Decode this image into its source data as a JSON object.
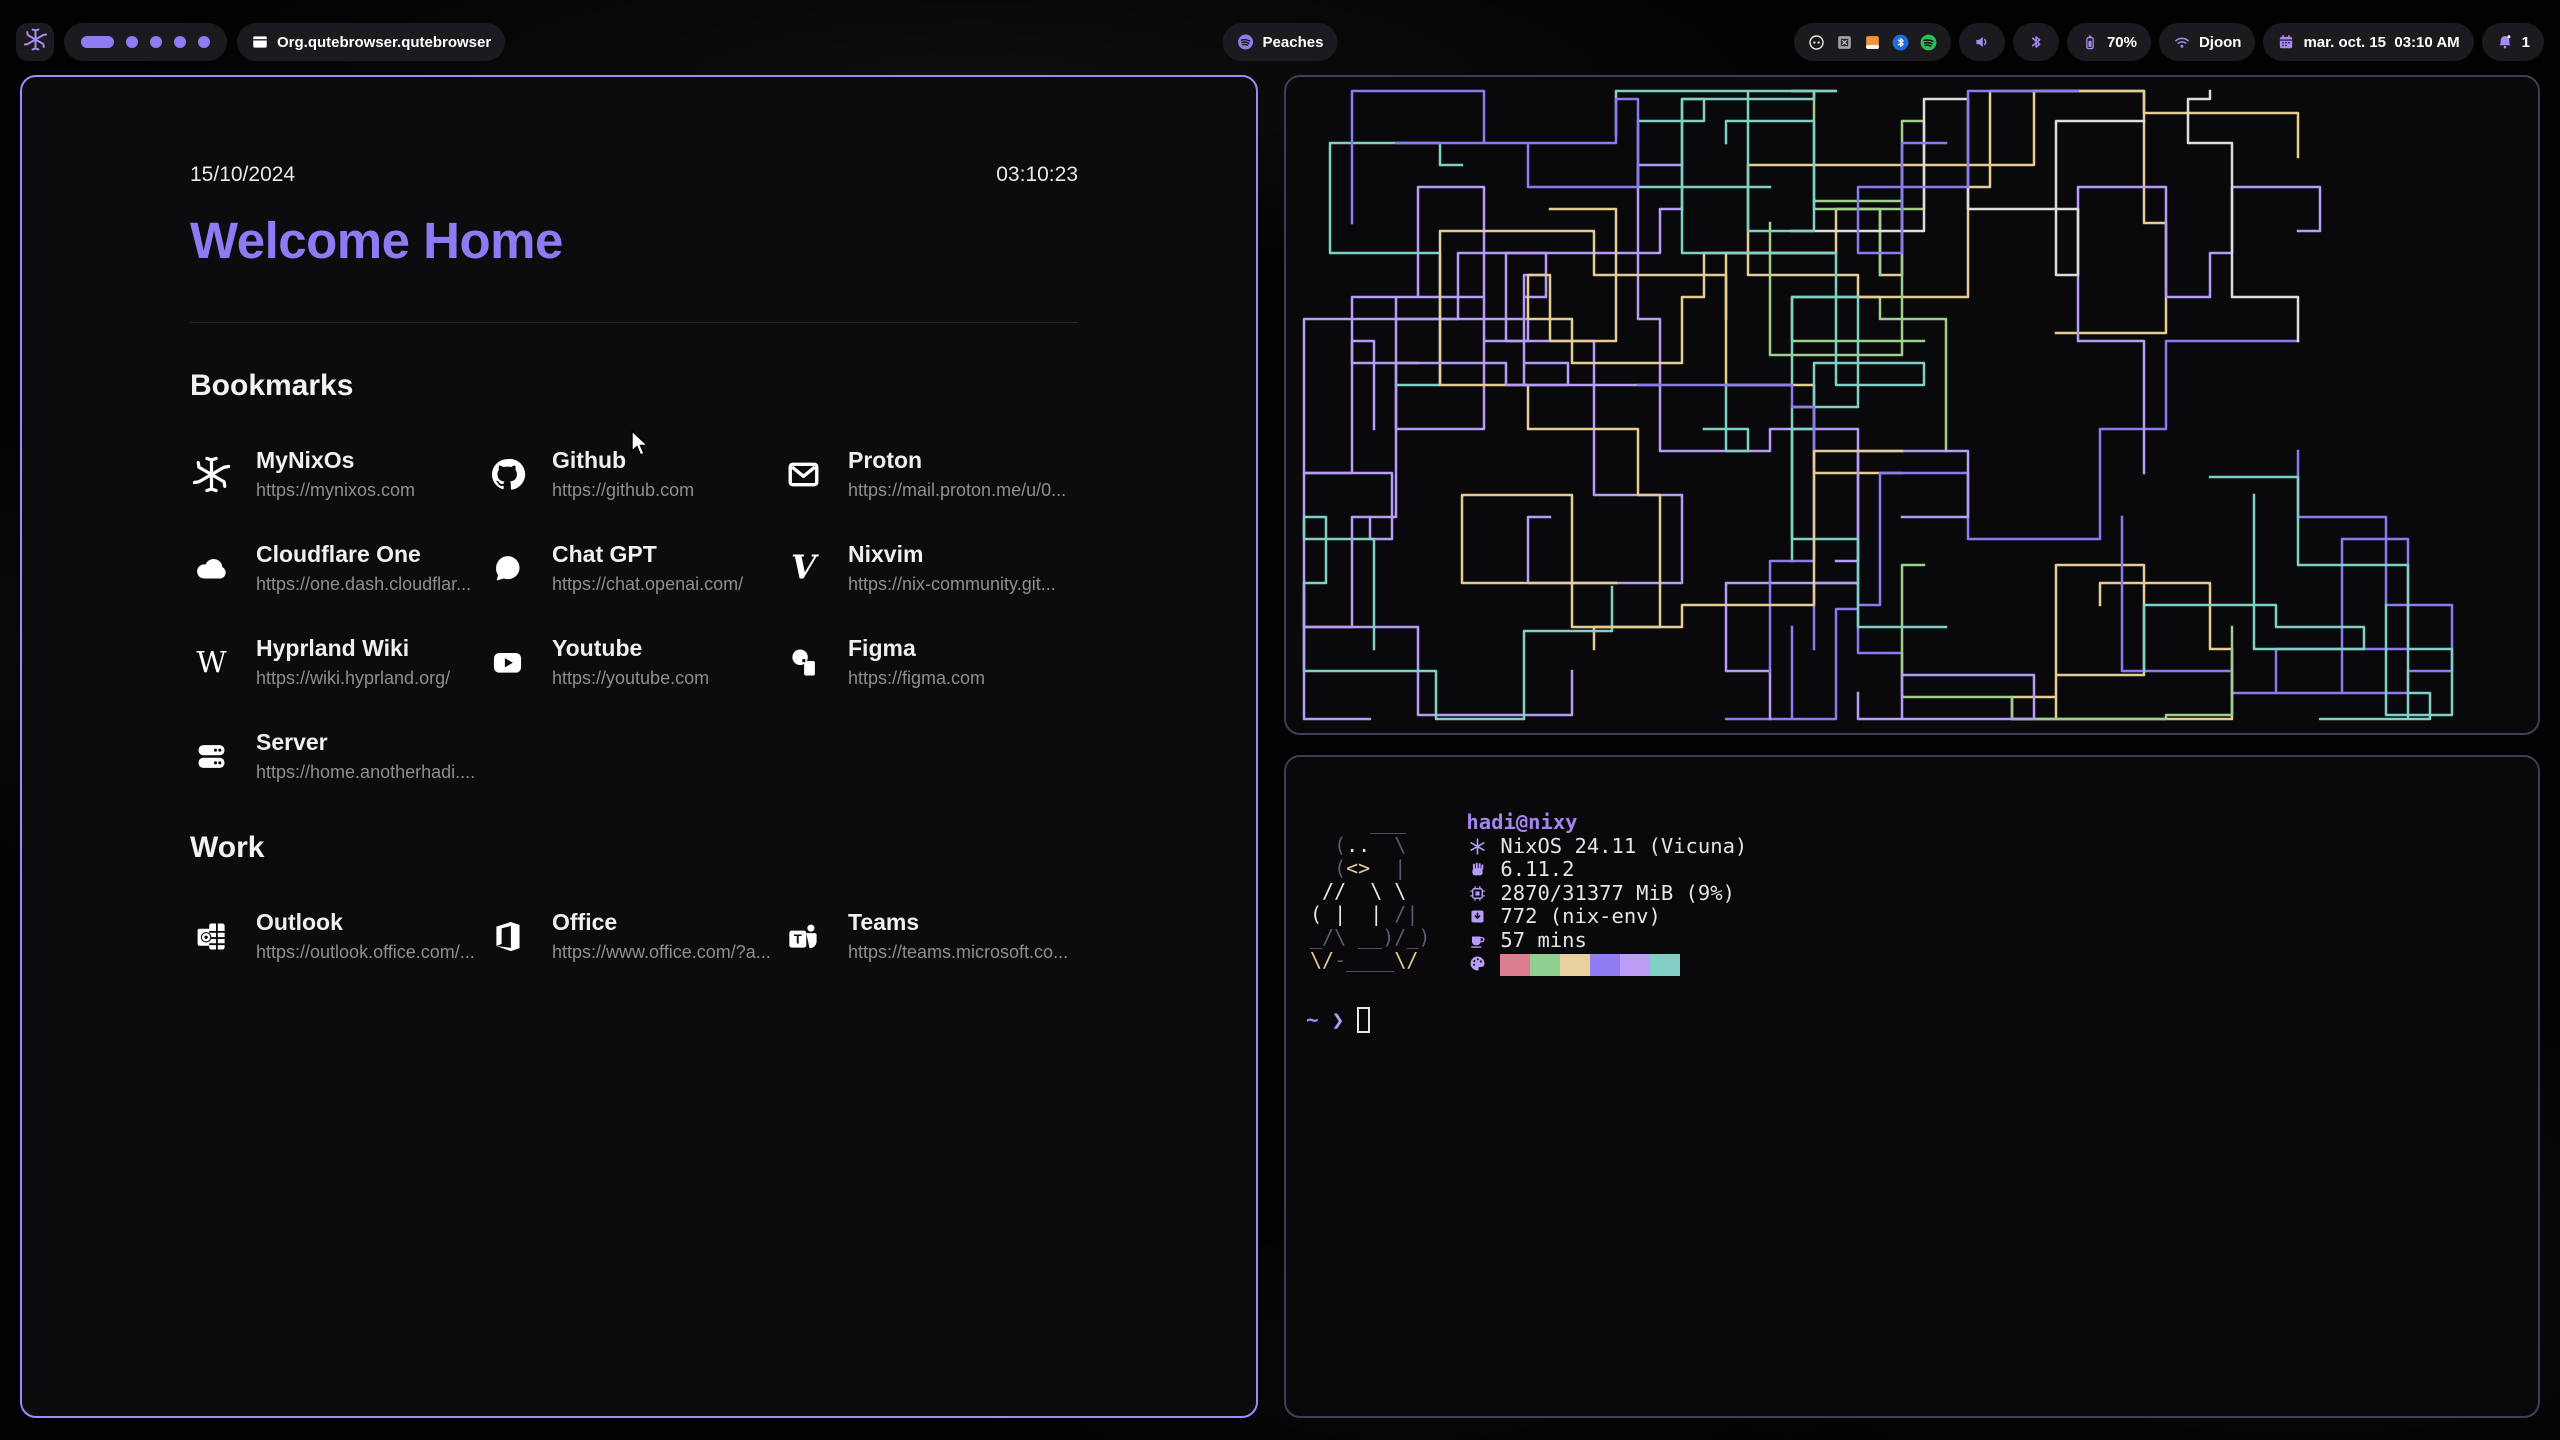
{
  "topbar": {
    "launcher": {
      "icon": "nix-snowflake-icon"
    },
    "workspaces": {
      "count": 5,
      "active_index": 0
    },
    "window": {
      "icon": "window-icon",
      "title": "Org.qutebrowser.qutebrowser"
    },
    "media": {
      "icon": "spotify-icon",
      "label": "Peaches"
    },
    "tray": [
      {
        "icon": "cast-icon"
      },
      {
        "icon": "box-app-icon"
      },
      {
        "icon": "files-app-icon"
      },
      {
        "icon": "bluetooth-badge-icon"
      },
      {
        "icon": "spotify-badge-icon"
      }
    ],
    "status": [
      {
        "name": "volume",
        "icon": "speaker-icon",
        "label": ""
      },
      {
        "name": "bluetooth",
        "icon": "bluetooth-icon",
        "label": ""
      },
      {
        "name": "battery",
        "icon": "battery-icon",
        "label": "70%"
      },
      {
        "name": "wifi",
        "icon": "wifi-icon",
        "label": "Djoon"
      },
      {
        "name": "clock",
        "icon": "calendar-icon",
        "label": "mar. oct. 15  03:10 AM"
      },
      {
        "name": "notifications",
        "icon": "bell-icon",
        "label": "1"
      }
    ]
  },
  "browser": {
    "date": "15/10/2024",
    "time": "03:10:23",
    "title": "Welcome Home",
    "sections": [
      {
        "heading": "Bookmarks",
        "items": [
          {
            "icon": "nix-snowflake-icon",
            "name": "MyNixOs",
            "url": "https://mynixos.com"
          },
          {
            "icon": "github-icon",
            "name": "Github",
            "url": "https://github.com"
          },
          {
            "icon": "mail-icon",
            "name": "Proton",
            "url": "https://mail.proton.me/u/0..."
          },
          {
            "icon": "cloud-icon",
            "name": "Cloudflare One",
            "url": "https://one.dash.cloudflar..."
          },
          {
            "icon": "chat-icon",
            "name": "Chat GPT",
            "url": "https://chat.openai.com/"
          },
          {
            "icon": "nixvim-icon",
            "name": "Nixvim",
            "url": "https://nix-community.git..."
          },
          {
            "icon": "wikipedia-icon",
            "name": "Hyprland Wiki",
            "url": "https://wiki.hyprland.org/"
          },
          {
            "icon": "youtube-icon",
            "name": "Youtube",
            "url": "https://youtube.com"
          },
          {
            "icon": "figma-icon",
            "name": "Figma",
            "url": "https://figma.com"
          },
          {
            "icon": "server-icon",
            "name": "Server",
            "url": "https://home.anotherhadi...."
          }
        ]
      },
      {
        "heading": "Work",
        "items": [
          {
            "icon": "outlook-icon",
            "name": "Outlook",
            "url": "https://outlook.office.com/..."
          },
          {
            "icon": "office-icon",
            "name": "Office",
            "url": "https://www.office.com/?a..."
          },
          {
            "icon": "teams-icon",
            "name": "Teams",
            "url": "https://teams.microsoft.co..."
          }
        ]
      }
    ]
  },
  "pipes": {
    "seed": 11,
    "count": 34,
    "colors": [
      "#7fd1c5",
      "#8b7af0",
      "#9ed08c",
      "#dcdcdc",
      "#e6cb93",
      "#b79cf6",
      "#7fd1c5",
      "#8b7af0"
    ]
  },
  "terminal": {
    "user_host": "hadi@nixy",
    "ascii": [
      [
        [
          "g",
          "     ___"
        ]
      ],
      [
        [
          "g",
          "  ("
        ],
        [
          "w",
          ".."
        ],
        [
          "g",
          "  \\"
        ]
      ],
      [
        [
          "g",
          "  ("
        ],
        [
          "y",
          "<>"
        ],
        [
          "g",
          "  |"
        ]
      ],
      [
        [
          "w",
          " //  \\ \\"
        ]
      ],
      [
        [
          "w",
          "( |  | "
        ],
        [
          "g",
          "/|"
        ]
      ],
      [
        [
          "g",
          "_/\\ __)/_)"
        ]
      ],
      [
        [
          "y",
          "\\/"
        ],
        [
          "g",
          "-____"
        ],
        [
          "y",
          "\\/"
        ]
      ]
    ],
    "info": [
      {
        "icon": "os-icon",
        "text": "NixOS 24.11 (Vicuna)"
      },
      {
        "icon": "kernel-icon",
        "text": "6.11.2"
      },
      {
        "icon": "memory-icon",
        "text": "2870/31377 MiB (9%)"
      },
      {
        "icon": "packages-icon",
        "text": "772 (nix-env)"
      },
      {
        "icon": "uptime-icon",
        "text": "57 mins"
      }
    ],
    "palette": [
      "#dd7e8e",
      "#8fcf90",
      "#e9d19e",
      "#8f7bf2",
      "#bb9df5",
      "#82cfc5"
    ],
    "prompt": {
      "cwd": "~",
      "symbol": "❯"
    }
  },
  "colors": {
    "accent": "#8f7bf2",
    "active_border": "#a18af8",
    "inactive_border": "#3e3e54"
  }
}
